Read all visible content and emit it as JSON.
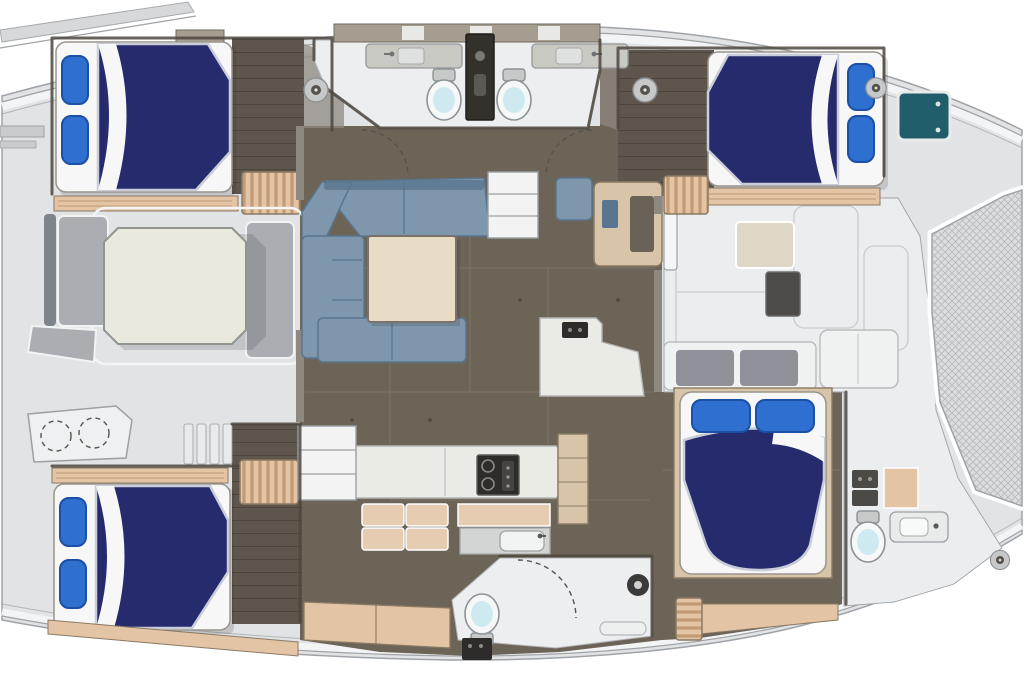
{
  "title": "Catamaran yacht interior floor plan, top view, bow to the right",
  "boat": {
    "type": "catamaran-floor-plan",
    "orientation": "bow-right",
    "visible_text": "none"
  },
  "palette": {
    "deck": "#e2e3e5",
    "deck_white": "#ebedee",
    "head_floor": "#eceef0",
    "hull_line": "#9fa3a7",
    "mesh_bg": "#dcdddf",
    "mesh_line": "#b7b9bc",
    "floor_dark": "#6d6458",
    "floor_seam": "#83796c",
    "plank": "#5e564c",
    "plank_line": "#4e463d",
    "wood_step": "#e3c4a4",
    "wood_grain": "#c29b74",
    "wood_light": "#d8c5a9",
    "wall_dark": "#4c463e",
    "wall_gray": "#8d8880",
    "mattress": "#f6f7f6",
    "duvet": "#252b6d",
    "duvet_edge": "#c9cdd9",
    "pillow": "#2e6fd0",
    "pillow_deep": "#1c4fa6",
    "sofa": "#7e97ac",
    "sofa_dark": "#5a7590",
    "table_cream": "#eae9dd",
    "table_beige": "#e9dcc5",
    "counter_white": "#ebebe6",
    "counter_beige": "#e6cdb2",
    "cabinet_tan": "#a59e90",
    "appliance": "#2d2c2a",
    "toilet_seat": "#cfe9f1",
    "fixture_gray": "#c7c9c9",
    "bench_gray": "#aaaeb2",
    "hatch_teal": "#215d6b",
    "shadow": "rgba(40,40,45,0.16)"
  },
  "rooms": [
    {
      "id": "aft-cockpit",
      "label": "Aft cockpit with octagonal dining table and bench seating"
    },
    {
      "id": "port-aft-cabin",
      "label": "Port aft guest cabin with double berth and two pillows"
    },
    {
      "id": "twin-heads",
      "label": "Twin heads: shared shower column, two toilets, two sink counters"
    },
    {
      "id": "starboard-aft-cabin",
      "label": "Starboard aft guest cabin with double berth and deck hatch"
    },
    {
      "id": "salon",
      "label": "Salon with U-shaped sofa and square coffee table"
    },
    {
      "id": "nav-station",
      "label": "Navigation desk with seat and companionway steps"
    },
    {
      "id": "galley",
      "label": "Galley with cooktop, sink, island and cabinets"
    },
    {
      "id": "port-forward-cabin",
      "label": "Port forward guest cabin with double berth and helm console"
    },
    {
      "id": "day-head",
      "label": "Day head with shower enclosure, toilet and bench"
    },
    {
      "id": "owner-cabin",
      "label": "Starboard forward cabin with double berth and en-suite head"
    },
    {
      "id": "forward-lounge",
      "label": "Forward deck lounge with seat boxes and white benches"
    },
    {
      "id": "trampoline",
      "label": "Bow trampoline netting"
    }
  ],
  "fixtures_summary": {
    "double_berths": 4,
    "toilets": 4,
    "sink_counters": 4,
    "shower_columns": 2,
    "dining_tables": 2,
    "helm_instrument_dials": 2,
    "deck_hatches": 1,
    "companionway_steps": 4,
    "deck_cleats": 4
  }
}
